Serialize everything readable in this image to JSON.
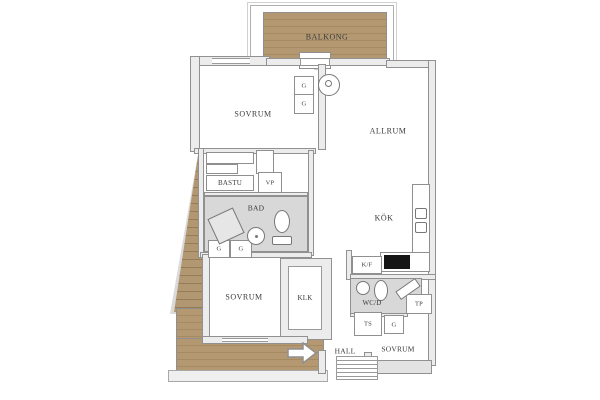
{
  "plan": {
    "title": "apartment-floor-plan",
    "labels": {
      "balkong": "BALKONG",
      "sovrum_top": "SOVRUM",
      "allrum": "ALLRUM",
      "bastu": "BASTU",
      "vp": "VP",
      "bad": "BAD",
      "kok": "KÖK",
      "garderob": "G",
      "kf": "K/F",
      "wcd": "WC/D",
      "tp": "TP",
      "ts": "TS",
      "klk": "KLK",
      "sovrum_left": "SOVRUM",
      "hall": "HALL",
      "sovrum_right": "SOVRUM"
    },
    "colors": {
      "wood": "#b39872",
      "wood_line": "#a68a62",
      "wall_fill": "#ececec",
      "wall_line": "#8f8f8f",
      "wet_floor": "#d8d8d8",
      "stove": "#151515",
      "text": "#3b3b3b",
      "background": "#ffffff"
    },
    "icons": {
      "entry_arrow": "arrow-right-icon"
    }
  }
}
